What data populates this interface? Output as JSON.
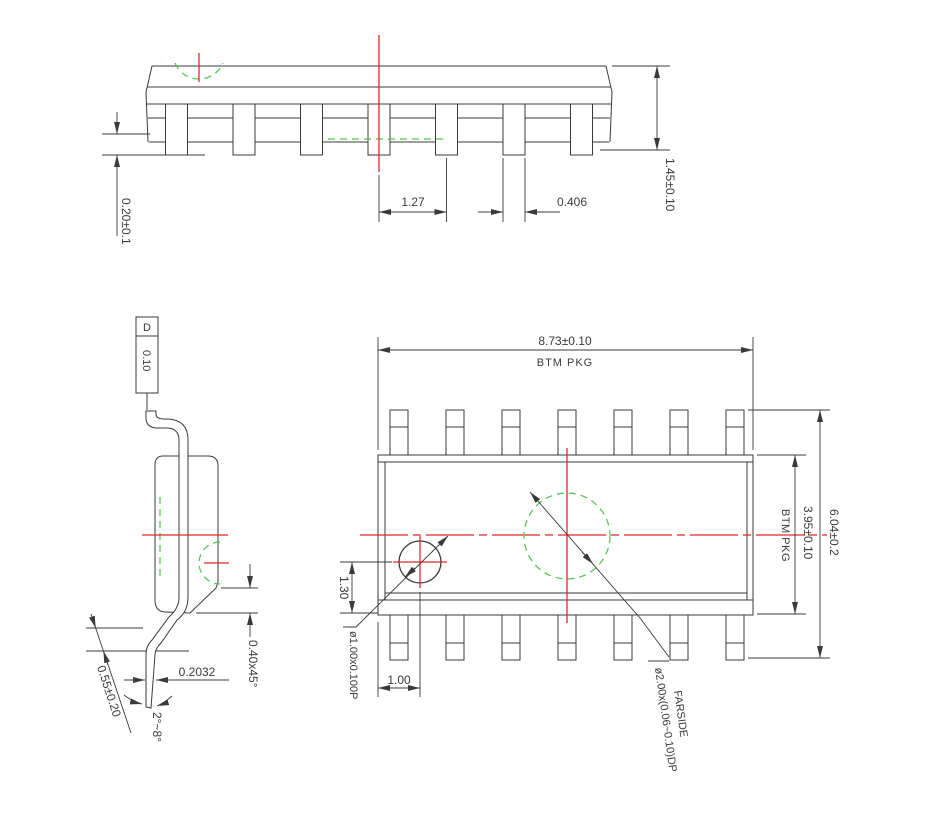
{
  "drawing": {
    "title": "IC package outline drawing (3 views)",
    "colors": {
      "line": "#3a3a3a",
      "red": "#e02828",
      "green": "#4fc34f"
    },
    "side_view": {
      "standoff": "0.20±0.1",
      "lead_pitch": "1.27",
      "lead_width": "0.406",
      "height": "1.45±0.10"
    },
    "end_view": {
      "datum": "D",
      "datum_tolerance": "0.10",
      "chamfer": "0.40x45°",
      "lead_thickness": "0.2032",
      "foot_length": "0.55±0.20",
      "foot_angle": "2°~8°"
    },
    "bottom_view": {
      "body_width": "8.73±0.10",
      "body_width_note": "BTM PKG",
      "body_depth": "3.95±0.10",
      "body_depth_note": "BTM PKG",
      "overall_depth": "6.04±0.2",
      "pin1_offset_y": "1.30",
      "pin1_offset_x": "1.00",
      "pin1_marker": "ø1.00x0.100P",
      "farside_marker": "ø2.00x(0.06~0.10)DP",
      "farside_note": "FARSIDE"
    }
  }
}
